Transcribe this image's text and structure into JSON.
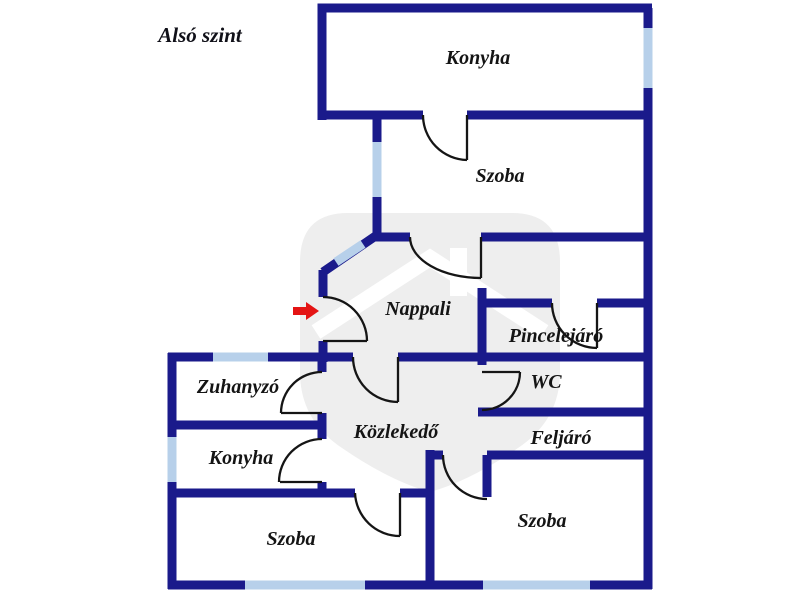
{
  "title": "Alsó szint",
  "rooms": {
    "konyha_top": "Konyha",
    "szoba_upper": "Szoba",
    "nappali": "Nappali",
    "pincelejaro": "Pincelejáró",
    "wc": "WC",
    "zuhanyzo": "Zuhanyzó",
    "kozlekedo": "Közlekedő",
    "feljaro": "Feljáró",
    "konyha_left": "Konyha",
    "szoba_bottom_left": "Szoba",
    "szoba_bottom_right": "Szoba"
  },
  "icons": {
    "entrance_arrow": "red-entrance-arrow"
  },
  "colors": {
    "wall": "#1a1a8b",
    "window": "#b7d0ea",
    "door": "#151515",
    "arrow": "#e41414",
    "watermark": "#eeeeee",
    "label": "#141414",
    "background": "#ffffff"
  }
}
